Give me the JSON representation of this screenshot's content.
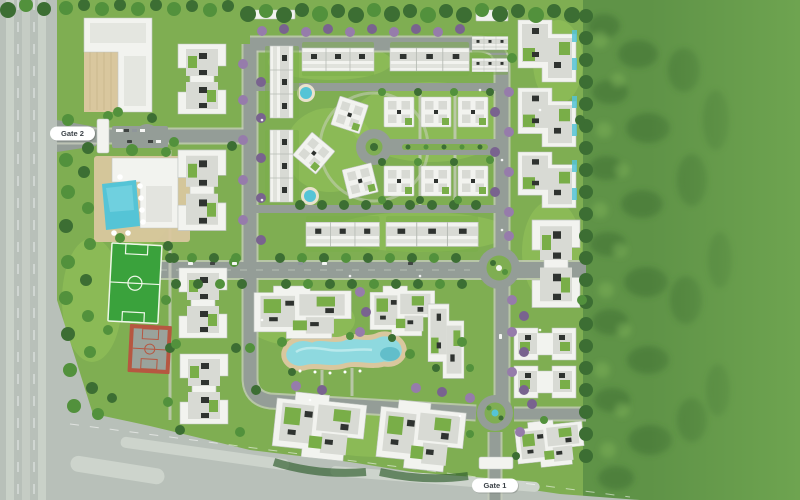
{
  "labels": {
    "gate1": "Gate 1",
    "gate2": "Gate 2"
  },
  "palette": {
    "site_grass": "#7fae52",
    "lawn_light": "#9cc95c",
    "forest_base": "#5f9347",
    "forest_flat": "#6ea450",
    "tree_dark": "#3c6e33",
    "tree_mid": "#52913c",
    "tree_light": "#6fb04a",
    "tree_purple": "#967cab",
    "tree_purple_dark": "#79638f",
    "highway": "#b8c0b9",
    "highway_light": "#cdd4cc",
    "road": "#949d97",
    "road_dark": "#7e8781",
    "sidewalk": "#c6ccbb",
    "building_white": "#f2f3ef",
    "building_shadow": "#c0c5c1",
    "roof_gray": "#d8dad4",
    "roof_dark": "#2f3330",
    "roof_green": "#79ae48",
    "pool_blue": "#55c4d6",
    "lagoon_blue": "#8ed9df",
    "deck_tan": "#d9c79e",
    "pitch_green": "#3aa23c",
    "pitch_line": "#eef7e8",
    "court_red": "#b65741",
    "court_gray": "#9aa39c",
    "hedge_dark": "#2f5d2c",
    "label_bg": "#ffffff",
    "label_text": "#3c4248"
  },
  "features": [
    "west-highway",
    "south-road",
    "east-forest",
    "entry-gate-1",
    "entry-gate-2",
    "gate2-roundabout",
    "central-roundabout",
    "south-roundabout",
    "cul-de-sac",
    "commercial-building",
    "clubhouse-pool",
    "football-pitch",
    "basketball-court",
    "central-lagoon-pool",
    "round-plunge-pools",
    "apartment-blocks",
    "townhouse-rows",
    "villas"
  ]
}
